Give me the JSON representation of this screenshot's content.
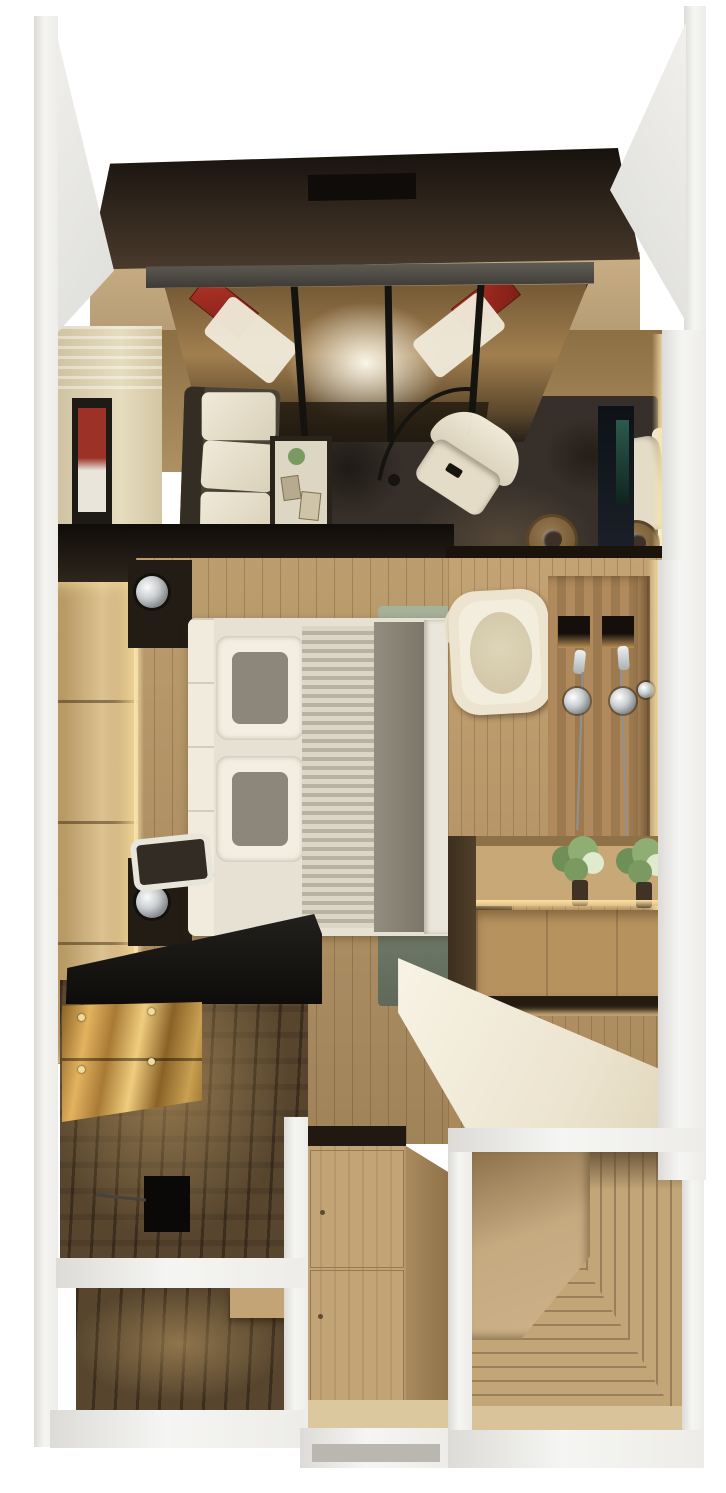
{
  "scene": {
    "type": "3d-floorplan-render",
    "description": "Top-down 3D render of a compact studio apartment with balcony, living room, bedroom, shower bathroom, kitchen, wardrobe and entry hall",
    "background": "#ffffff",
    "rooms": [
      {
        "id": "balcony",
        "name": "Balcony terrace with dark canopy, glass roof and red sun loungers"
      },
      {
        "id": "living-room",
        "name": "Living room with sofa, cream armchairs, dark area rug and wall art"
      },
      {
        "id": "bedroom",
        "name": "Bedroom with double bed, padded headboard wall and bedside lamps"
      },
      {
        "id": "bathroom",
        "name": "Shower bathroom with freestanding tub and twin shower panel"
      },
      {
        "id": "kitchen",
        "name": "Kitchen with black counter, glossy cabinets and dark wood floor"
      },
      {
        "id": "vanity",
        "name": "Vanity / desk corner with white counter, wood shelves and flower vases"
      },
      {
        "id": "wardrobe",
        "name": "Built-in wardrobe closet"
      },
      {
        "id": "entry",
        "name": "Entry hall with mitered picture-frame wood floor"
      },
      {
        "id": "utility",
        "name": "Utility room with dark wood floor"
      }
    ],
    "furniture": {
      "loungers": "Red sun loungers with white cushions",
      "canopy": "Dark louvred canopy roof",
      "glass_roof": "Black-framed glass roof over living room",
      "sofa": "Grey sofa with white cushions",
      "armchairs": "Cream swivel armchairs",
      "side_tables": "Round wicker side tables",
      "floor_lamp": "Black arc floor lamp",
      "tv_console": "Dark media console",
      "wall_art": "Framed red artwork",
      "bed": "Double bed with grey throw and two pillows",
      "bed_lamps": "Chrome bedside table lamps",
      "bench": "Upholstered bench at bed foot",
      "green_rug": "Green gradient bedroom rug",
      "tub": "Cream freestanding bathtub",
      "shower_panel": "Wood shower panel with two chrome mixers and niches",
      "plants": "White flower arrangements in dark vases",
      "white_counter": "White vanity counter",
      "black_counter": "Black kitchen countertop",
      "gloss_cabinets": "High-gloss amber kitchen cabinets",
      "wardrobe_doors": "Oak wardrobe doors",
      "entry_platform": "Raised entry step platform"
    },
    "palette": {
      "bg": "#ffffff",
      "wall": "#efeeea",
      "canopy": "#16110d",
      "deck": "#c9ae84",
      "red": "#b23327",
      "cream": "#efe9d9",
      "cwall": "#e6dcbf",
      "artred": "#9c3227",
      "rug": "#37302a",
      "wood": "#ad9064",
      "headboard": "#dcc291",
      "glow": "#f7e3ab",
      "night": "#221c15",
      "chrome": "#c9ccce",
      "bedwhite": "#e6e1d2",
      "bedgrey": "#8d877b",
      "blanket": "#7b7568",
      "greenrug1": "#a6b29b",
      "greenrug2": "#5d685a",
      "black": "#0e0c0a",
      "gloss": "#a87a35",
      "darkwood": "#57452e",
      "oak": "#c3a477",
      "entrywood": "#c2a678",
      "vanity": "#ece4cf",
      "shelfwood": "#c9a877",
      "shelfwood2": "#b6925f",
      "showerwood": "#b08a5c",
      "showerfloor": "#b79a6c",
      "plant": "#7a9a62",
      "tv": "#0d1118"
    }
  }
}
